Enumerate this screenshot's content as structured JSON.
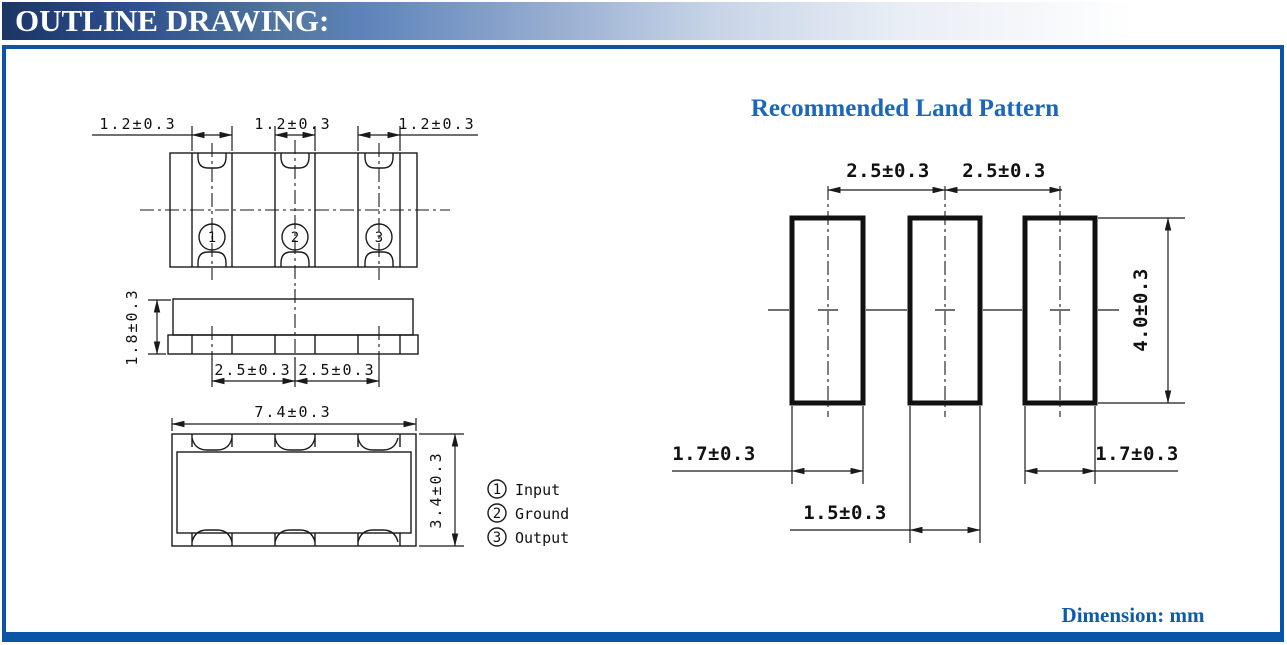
{
  "header": {
    "title": "OUTLINE DRAWING:"
  },
  "footer": {
    "note": "Dimension: mm"
  },
  "colors": {
    "accent_blue": "#0b55a6",
    "heading_blue": "#1a67c0",
    "line_black": "#1a1a1a"
  },
  "outline_drawing": {
    "top_view": {
      "pad_width_dims": [
        "1.2±0.3",
        "1.2±0.3",
        "1.2±0.3"
      ]
    },
    "side_view": {
      "height_dim": "1.8±0.3",
      "pitch_dims": [
        "2.5±0.3",
        "2.5±0.3"
      ]
    },
    "bottom_view": {
      "width_dim": "7.4±0.3",
      "depth_dim": "3.4±0.3"
    }
  },
  "land_pattern": {
    "title": "Recommended Land Pattern",
    "pitch_dims": [
      "2.5±0.3",
      "2.5±0.3"
    ],
    "pad_height_dim": "4.0±0.3",
    "pad_width_dims": [
      "1.7±0.3",
      "1.5±0.3",
      "1.7±0.3"
    ]
  },
  "pin_legend": [
    {
      "num": "1",
      "label": "Input"
    },
    {
      "num": "2",
      "label": "Ground"
    },
    {
      "num": "3",
      "label": "Output"
    }
  ]
}
